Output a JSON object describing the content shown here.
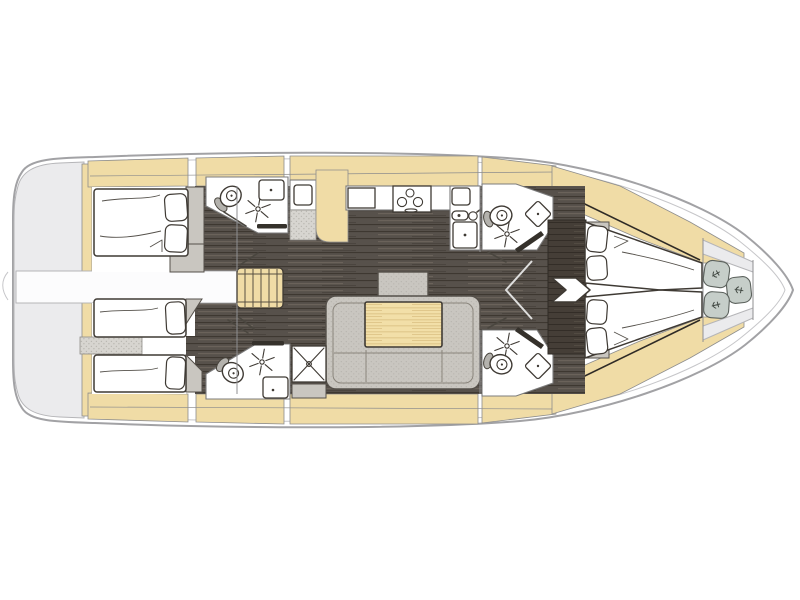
{
  "meta": {
    "description": "Sailing yacht interior deck layout plan, bow pointing right, no text labels",
    "orientation": "bow-right",
    "canvas": {
      "width": 800,
      "height": 600
    }
  },
  "colors": {
    "page-bg": "#ffffff",
    "hull-stroke": "#a2a2a5",
    "hull-inner-stroke": "#c6c6c9",
    "transom-fill": "#ebebed",
    "transom-stroke": "#b5b5b8",
    "deck-tan": "#f0dca6",
    "deck-stroke": "#8d8d8d",
    "floor-base": "#57514b",
    "floor-grain-dark": "#3e3831",
    "floor-grain-light": "#6e675e",
    "wardrobe-base": "#453e37",
    "room-white": "#ffffff",
    "room-stroke": "#7c7c7c",
    "fixture-stroke": "#3f3a34",
    "furniture-gray": "#c9c6c0",
    "furniture-stroke": "#55504a",
    "hatch-gray": "#d7d5d0",
    "hatch-dot": "#b9b7b1",
    "table-tan": "#f2dfa8",
    "table-grain": "#dcc184",
    "cushion-gray": "#c6cec9",
    "bar-dark": "#35312b",
    "passage-white": "#fcfcfd"
  },
  "areas": [
    {
      "id": "swim-platform",
      "features": [
        "transom",
        "boarding-ladder"
      ]
    },
    {
      "id": "aft-cabin-port",
      "features": [
        "double-berth",
        "two-pillows",
        "wardrobe"
      ]
    },
    {
      "id": "aft-cabin-starboard",
      "features": [
        "twin-berths",
        "pillows",
        "divider"
      ]
    },
    {
      "id": "aft-head-port",
      "features": [
        "toilet",
        "shower-spray",
        "washbasin"
      ]
    },
    {
      "id": "aft-head-starboard",
      "features": [
        "toilet",
        "shower-spray",
        "washbasin",
        "shower-stall"
      ]
    },
    {
      "id": "companionway-stairs",
      "features": [
        "five-treads"
      ]
    },
    {
      "id": "nav-locker",
      "features": [
        "shelf",
        "hatched-locker",
        "wood-cabinet"
      ]
    },
    {
      "id": "galley",
      "features": [
        "three-burner-stove",
        "sink",
        "faucet",
        "counters"
      ]
    },
    {
      "id": "salon",
      "features": [
        "u-shaped-sofa",
        "wood-table",
        "stool"
      ]
    },
    {
      "id": "forward-head-port",
      "features": [
        "toilet",
        "shower-spray",
        "washbasin"
      ]
    },
    {
      "id": "forward-head-starboard",
      "features": [
        "toilet",
        "shower-spray",
        "washbasin"
      ]
    },
    {
      "id": "forward-cabin",
      "features": [
        "v-berth",
        "four-pillows",
        "wardrobe"
      ]
    },
    {
      "id": "bow-locker",
      "features": [
        "three-cushions"
      ]
    }
  ]
}
